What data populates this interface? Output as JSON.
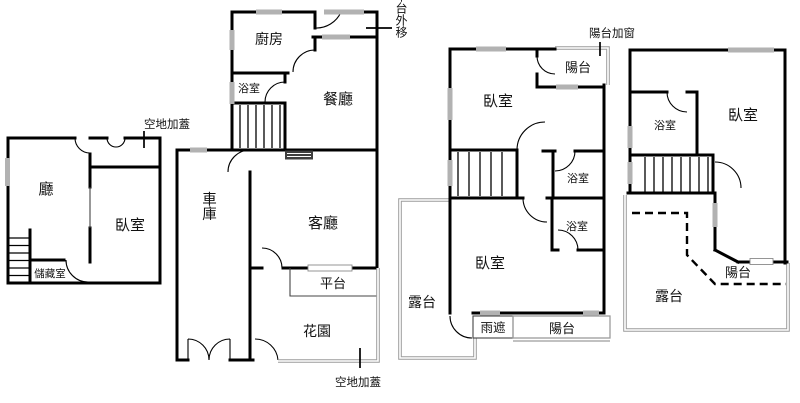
{
  "colors": {
    "background": "#ffffff",
    "wall": "#000000",
    "window": "#b2b2b2",
    "outdoor": "#9c9c9c",
    "shade": "#3f3f3f",
    "text": "#111111"
  },
  "annotations": {
    "vacant_cover_top": "空地加蓋",
    "platform_moved_out": "平台外移",
    "balcony_added_window": "陽台加窗",
    "vacant_cover_bottom": "空地加蓋"
  },
  "unit1": {
    "hall": "廳",
    "bedroom": "臥室",
    "storage": "儲藏室"
  },
  "unit2": {
    "kitchen": "廚房",
    "bathroom": "浴室",
    "dining": "餐廳",
    "garage": "車庫",
    "living": "客廳",
    "platform": "平台",
    "garden": "花園"
  },
  "unit3": {
    "balcony_top": "陽台",
    "bedroom_top": "臥室",
    "bathroom_upper": "浴室",
    "bathroom_lower": "浴室",
    "bedroom_lower": "臥室",
    "terrace": "露台",
    "rain_cover": "雨遮",
    "balcony_bottom": "陽台"
  },
  "unit4": {
    "bathroom": "浴室",
    "bedroom": "臥室",
    "balcony": "陽台",
    "terrace": "露台"
  }
}
